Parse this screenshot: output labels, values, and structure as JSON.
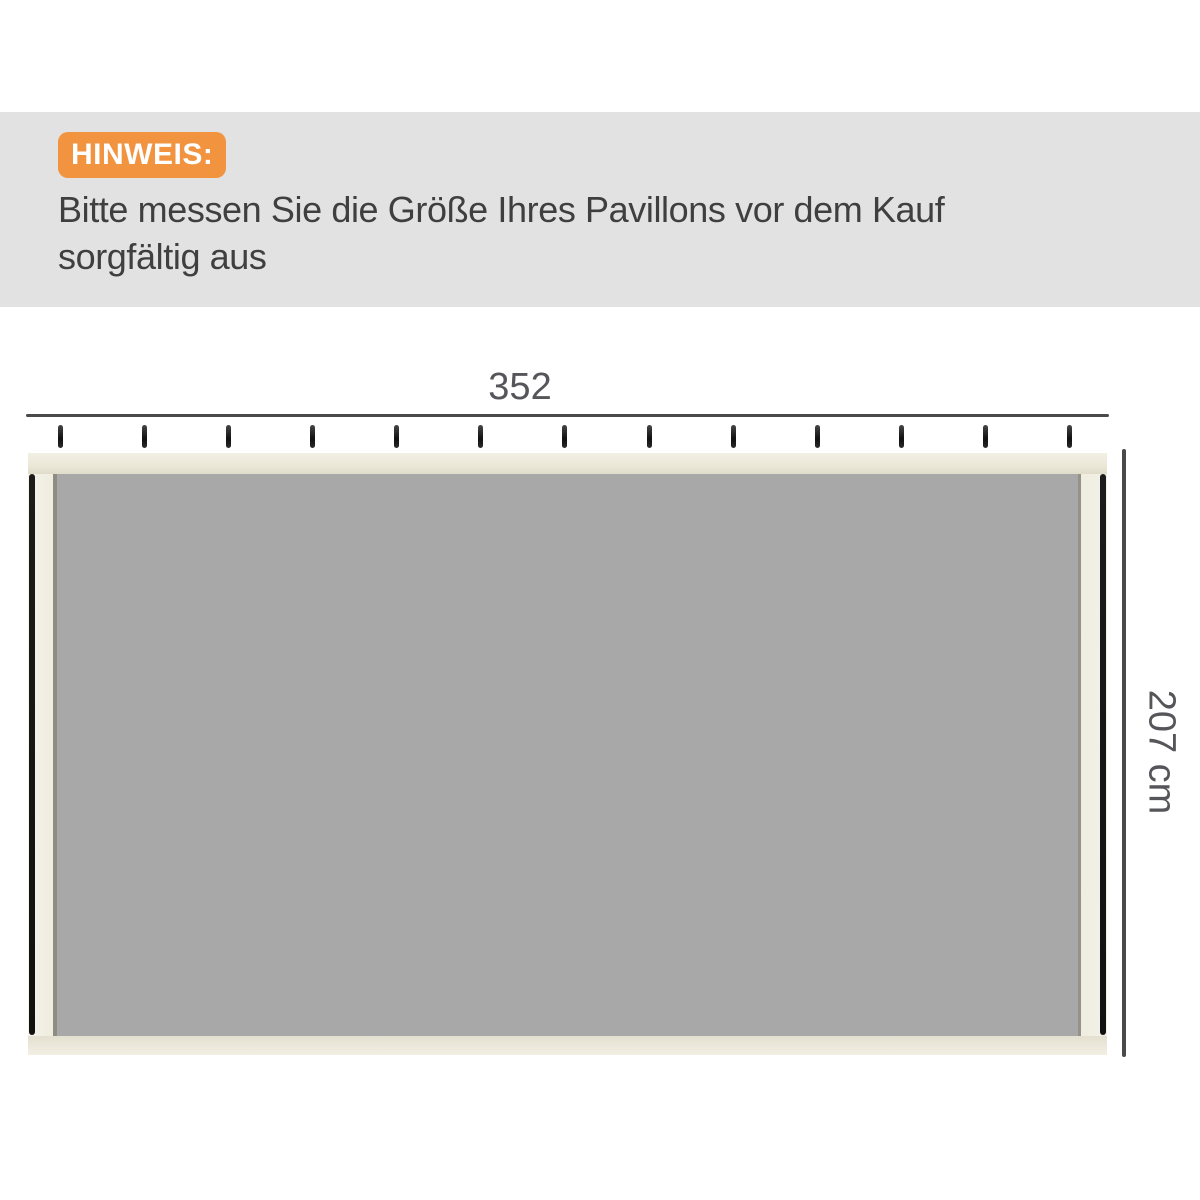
{
  "notice": {
    "badge": "HINWEIS:",
    "line1": "Bitte messen Sie die Größe Ihres Pavillons vor dem Kauf",
    "line2": "sorgfältig aus"
  },
  "diagram": {
    "width_label": "352",
    "height_label": "207 cm",
    "hook_count": 13
  },
  "colors": {
    "banner_bg": "#e2e2e2",
    "badge_bg": "#f2933f",
    "notice_text": "#3f3f3f",
    "dim_line": "#4a4a4a",
    "dim_text": "#55555a",
    "panel_gray": "#a8a8a8"
  }
}
